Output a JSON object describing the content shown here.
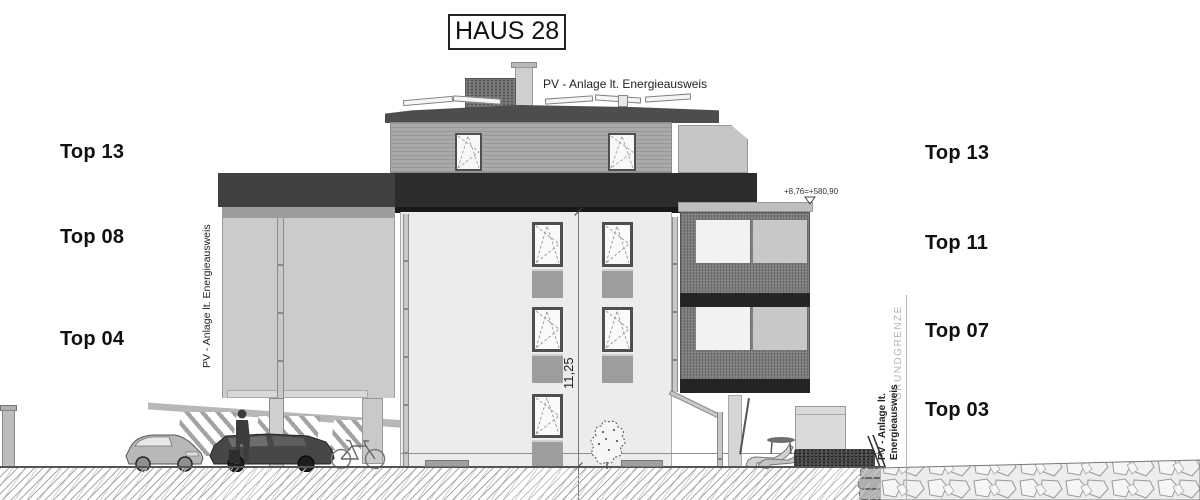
{
  "title": "HAUS 28",
  "annotations": {
    "pv_top": "PV - Anlage lt. Energieausweis",
    "pv_left_vertical": "PV - Anlage lt. Energieausweis",
    "pv_right_line1": "PV - Anlage lt.",
    "pv_right_line2": "Energieausweis",
    "grundgrenze": "GRUNDGRENZE",
    "dimension_height": "11,25",
    "elevation_marker": "+8,76=+580,90"
  },
  "labels": {
    "left": [
      {
        "text": "Top 13"
      },
      {
        "text": "Top 08"
      },
      {
        "text": "Top 04"
      }
    ],
    "right": [
      {
        "text": "Top 13"
      },
      {
        "text": "Top 11"
      },
      {
        "text": "Top 07"
      },
      {
        "text": "Top 03"
      }
    ]
  },
  "colors": {
    "facade": "#ececec",
    "side_wall": "#cbcbcb",
    "parapet_dark": "#2c2c2c",
    "roof": "#4d4d4d",
    "balcony_mesh": "#7c7c7c",
    "penthouse_wood": "#a9a9a9"
  }
}
